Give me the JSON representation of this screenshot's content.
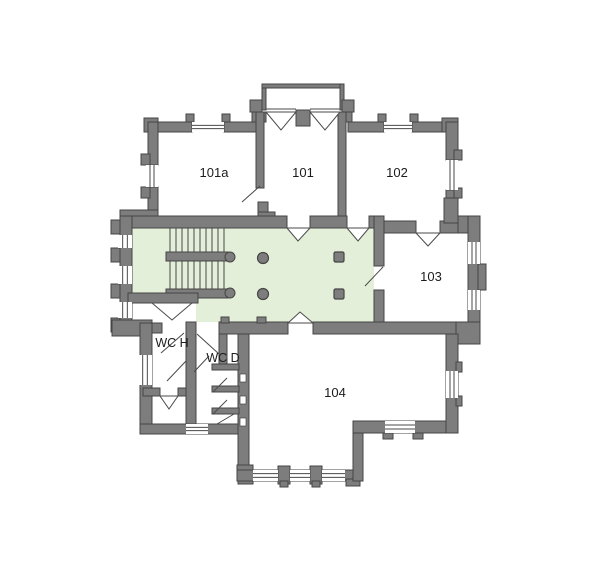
{
  "plan_title": "first-floor-plan",
  "colors": {
    "background": "#ffffff",
    "wall_fill": "#7d7d7d",
    "wall_stroke": "#454545",
    "corridor_fill": "#e3efd8",
    "line": "#4a4a4a",
    "text": "#1c1c1c",
    "window_fill": "#ffffff"
  },
  "rooms": [
    {
      "id": "101a",
      "label": "101a",
      "x": 214,
      "y": 177,
      "size": 13
    },
    {
      "id": "101",
      "label": "101",
      "x": 303,
      "y": 177,
      "size": 13
    },
    {
      "id": "102",
      "label": "102",
      "x": 397,
      "y": 177,
      "size": 13
    },
    {
      "id": "103",
      "label": "103",
      "x": 431,
      "y": 281,
      "size": 13
    },
    {
      "id": "104",
      "label": "104",
      "x": 335,
      "y": 397,
      "size": 13
    },
    {
      "id": "wc-h",
      "label": "WC H",
      "x": 172,
      "y": 347,
      "size": 12.5
    },
    {
      "id": "wc-d",
      "label": "WC D",
      "x": 223,
      "y": 362,
      "size": 12.5
    }
  ],
  "geometry": {
    "canvas": {
      "w": 600,
      "h": 570
    },
    "corridor_polygon": "132,228 374,228 374,322 196,322 196,293 132,293",
    "walls": [
      [
        262,
        84,
        4,
        26,
        "porch-wall-left"
      ],
      [
        262,
        84,
        82,
        4,
        "porch-wall-top"
      ],
      [
        340,
        84,
        4,
        26,
        "porch-wall-right"
      ],
      [
        250,
        100,
        12,
        12,
        "porch-flange-left"
      ],
      [
        342,
        100,
        12,
        12,
        "porch-flange-right"
      ],
      [
        252,
        112,
        14,
        10,
        "room101-top-wall-left"
      ],
      [
        296,
        110,
        14,
        16,
        "porch-center-pier"
      ],
      [
        340,
        112,
        12,
        10,
        "room101-top-wall-right"
      ],
      [
        144,
        118,
        14,
        14,
        "corner-101a-nw"
      ],
      [
        148,
        122,
        44,
        10,
        "room101a-top-wall-left"
      ],
      [
        224,
        122,
        32,
        10,
        "room101a-top-wall-right"
      ],
      [
        186,
        114,
        8,
        8,
        "pier-101a-window-left"
      ],
      [
        222,
        114,
        8,
        8,
        "pier-101a-window-right"
      ],
      [
        348,
        122,
        36,
        10,
        "room102-top-wall-left"
      ],
      [
        412,
        122,
        34,
        10,
        "room102-top-wall-right"
      ],
      [
        378,
        114,
        8,
        8,
        "pier-102-window-left"
      ],
      [
        410,
        114,
        8,
        8,
        "pier-102-window-right"
      ],
      [
        442,
        118,
        16,
        14,
        "corner-102-ne"
      ],
      [
        148,
        122,
        10,
        43,
        "room101a-west-wall-upper"
      ],
      [
        148,
        187,
        10,
        31,
        "room101a-west-wall-lower"
      ],
      [
        141,
        154,
        9,
        11,
        "pilaster-west-a"
      ],
      [
        141,
        187,
        9,
        11,
        "pilaster-west-b"
      ],
      [
        446,
        122,
        12,
        38,
        "east-wall-upper"
      ],
      [
        446,
        190,
        12,
        26,
        "east-wall-lower"
      ],
      [
        454,
        150,
        8,
        10,
        "pilaster-east-a"
      ],
      [
        454,
        188,
        8,
        10,
        "pilaster-east-b"
      ],
      [
        256,
        112,
        8,
        76,
        "wall-101a-101"
      ],
      [
        258,
        202,
        10,
        10,
        "block-101-sw-a"
      ],
      [
        258,
        212,
        17,
        8,
        "block-101-sw-b"
      ],
      [
        338,
        112,
        8,
        104,
        "wall-101-102"
      ],
      [
        120,
        210,
        38,
        10,
        "corner-nw-block"
      ],
      [
        120,
        216,
        167,
        12,
        "corridor-north-wall-west"
      ],
      [
        310,
        216,
        37,
        12,
        "corridor-north-wall-mid"
      ],
      [
        369,
        216,
        15,
        12,
        "corridor-north-wall-east"
      ],
      [
        384,
        221,
        32,
        12,
        "room103-north-wall-west"
      ],
      [
        440,
        221,
        40,
        12,
        "room103-north-wall-east"
      ],
      [
        444,
        198,
        14,
        25,
        "pier-103-north"
      ],
      [
        458,
        216,
        22,
        17,
        "corner-ne-block"
      ],
      [
        120,
        216,
        12,
        120,
        "west-outer-wall"
      ],
      [
        111,
        220,
        9,
        14,
        "pilaster-west-1"
      ],
      [
        111,
        248,
        9,
        14,
        "pilaster-west-2"
      ],
      [
        111,
        284,
        9,
        14,
        "pilaster-west-3"
      ],
      [
        111,
        318,
        9,
        14,
        "pilaster-west-4"
      ],
      [
        374,
        216,
        10,
        50,
        "wall-corridor-103-upper"
      ],
      [
        374,
        290,
        10,
        44,
        "wall-corridor-103-lower"
      ],
      [
        468,
        216,
        12,
        118,
        "room103-east-wall"
      ],
      [
        478,
        264,
        8,
        26,
        "pilaster-east-103"
      ],
      [
        456,
        322,
        24,
        22,
        "corner-se-103-block"
      ],
      [
        219,
        322,
        69,
        12,
        "corridor-south-wall-west"
      ],
      [
        313,
        322,
        143,
        12,
        "corridor-south-wall-east"
      ],
      [
        221,
        317,
        8,
        6,
        "tab-corridor-a"
      ],
      [
        257,
        317,
        9,
        6,
        "tab-corridor-b"
      ],
      [
        128,
        293,
        70,
        10,
        "vestibule-north-wall"
      ],
      [
        186,
        322,
        10,
        102,
        "wall-wch-wcd"
      ],
      [
        140,
        323,
        22,
        10,
        "wc-north-wall"
      ],
      [
        112,
        320,
        40,
        16,
        "corner-sw-block"
      ],
      [
        140,
        323,
        12,
        111,
        "wc-west-wall"
      ],
      [
        140,
        424,
        98,
        10,
        "wc-south-wall"
      ],
      [
        143,
        388,
        17,
        8,
        "wch-partition-west"
      ],
      [
        178,
        388,
        8,
        8,
        "wch-partition-east"
      ],
      [
        238,
        334,
        11,
        136,
        "room104-west-wall"
      ],
      [
        212,
        364,
        27,
        6,
        "stall-divider-1"
      ],
      [
        212,
        386,
        27,
        6,
        "stall-divider-2"
      ],
      [
        212,
        408,
        27,
        6,
        "stall-divider-3"
      ],
      [
        219,
        334,
        8,
        30,
        "wcd-inner-wall"
      ],
      [
        237,
        465,
        16,
        12,
        "bay-corner-west"
      ],
      [
        238,
        477,
        15,
        7,
        "bay-foot-west"
      ],
      [
        237,
        470,
        126,
        11,
        "bay-south-wall"
      ],
      [
        278,
        466,
        12,
        18,
        "bay-pilaster-1"
      ],
      [
        280,
        481,
        8,
        6,
        "bay-foot-1"
      ],
      [
        310,
        466,
        12,
        18,
        "bay-pilaster-2"
      ],
      [
        312,
        481,
        8,
        6,
        "bay-foot-2"
      ],
      [
        346,
        479,
        14,
        7,
        "bay-foot-east"
      ],
      [
        353,
        421,
        10,
        60,
        "room104-step-wall"
      ],
      [
        353,
        421,
        105,
        12,
        "room104-south-wall-east"
      ],
      [
        383,
        433,
        10,
        6,
        "tab-104-a"
      ],
      [
        413,
        433,
        10,
        6,
        "tab-104-b"
      ],
      [
        446,
        334,
        12,
        99,
        "room104-east-wall"
      ],
      [
        456,
        362,
        6,
        10,
        "pilaster-104-a"
      ],
      [
        456,
        396,
        6,
        10,
        "pilaster-104-b"
      ]
    ],
    "windows": [
      [
        192,
        122,
        32,
        10,
        "h",
        "window-101a-north"
      ],
      [
        384,
        122,
        28,
        10,
        "h",
        "window-102-north"
      ],
      [
        146,
        165,
        12,
        22,
        "v",
        "window-101a-west"
      ],
      [
        446,
        160,
        12,
        30,
        "v",
        "window-102-east"
      ],
      [
        118,
        235,
        14,
        13,
        "v",
        "window-corridor-west-1"
      ],
      [
        118,
        266,
        14,
        18,
        "v",
        "window-corridor-west-2"
      ],
      [
        118,
        302,
        14,
        16,
        "v",
        "window-corridor-west-3"
      ],
      [
        468,
        242,
        12,
        22,
        "v",
        "window-103-east-1"
      ],
      [
        468,
        290,
        12,
        20,
        "v",
        "window-103-east-2"
      ],
      [
        138,
        355,
        14,
        30,
        "v",
        "window-wc-west"
      ],
      [
        186,
        424,
        22,
        10,
        "h",
        "window-wc-south"
      ],
      [
        253,
        470,
        25,
        11,
        "h",
        "window-bay-1"
      ],
      [
        290,
        470,
        20,
        11,
        "h",
        "window-bay-2"
      ],
      [
        322,
        470,
        23,
        11,
        "h",
        "window-bay-3"
      ],
      [
        385,
        421,
        30,
        12,
        "h",
        "window-104-south"
      ],
      [
        446,
        371,
        12,
        27,
        "v",
        "window-104-east"
      ]
    ],
    "door_leaves": [
      [
        260,
        186,
        242,
        202,
        "door-101a-101"
      ],
      [
        383,
        267,
        365,
        286,
        "door-corridor-103"
      ],
      [
        184,
        333,
        161,
        353,
        "door-wch"
      ],
      [
        197,
        334,
        219,
        354,
        "door-wcd"
      ],
      [
        186,
        361,
        167,
        381,
        "door-wch-inner"
      ],
      [
        194,
        372,
        209,
        356,
        "door-wcd-inner"
      ],
      [
        213,
        392,
        227,
        378,
        "door-stall-1"
      ],
      [
        213,
        414,
        227,
        400,
        "door-stall-2"
      ],
      [
        217,
        424,
        234,
        414,
        "door-stall-3"
      ]
    ],
    "door_swings": [
      [
        266,
        112,
        281,
        130,
        296,
        112,
        "porch-door-west"
      ],
      [
        310,
        112,
        325,
        130,
        340,
        112,
        "porch-door-east"
      ],
      [
        287,
        228,
        298,
        241,
        310,
        228,
        "door-101-corridor"
      ],
      [
        347,
        228,
        358,
        241,
        369,
        228,
        "door-102-corridor"
      ],
      [
        416,
        233,
        428,
        246,
        440,
        233,
        "door-103"
      ],
      [
        288,
        323,
        300,
        312,
        313,
        323,
        "door-104"
      ],
      [
        152,
        303,
        172,
        320,
        192,
        303,
        "door-vestibule"
      ],
      [
        160,
        396,
        169,
        409,
        178,
        396,
        "door-store"
      ]
    ],
    "lintel_lines": [
      [
        266,
        109,
        296,
        109,
        "porch-threshold-west"
      ],
      [
        310,
        109,
        340,
        109,
        "porch-threshold-east"
      ]
    ],
    "stairs": {
      "tread_xs": [
        170,
        176,
        182,
        188,
        194,
        200,
        206,
        212,
        218,
        224
      ],
      "upper_flight": [
        228,
        252
      ],
      "lower_flight": [
        261,
        289
      ],
      "rails": [
        [
          166,
          252,
          62,
          9
        ],
        [
          166,
          289,
          62,
          9
        ]
      ],
      "rail_caps": [
        [
          230,
          257,
          5
        ],
        [
          230,
          293,
          5
        ]
      ]
    },
    "columns": {
      "round": [
        [
          263,
          258,
          5.5
        ],
        [
          263,
          294,
          5.5
        ]
      ],
      "square": [
        [
          334,
          252,
          10,
          10
        ],
        [
          334,
          289,
          10,
          10
        ]
      ]
    },
    "wall_notches": [
      [
        240,
        374,
        6,
        8
      ],
      [
        240,
        396,
        6,
        8
      ],
      [
        240,
        418,
        6,
        8
      ]
    ]
  }
}
